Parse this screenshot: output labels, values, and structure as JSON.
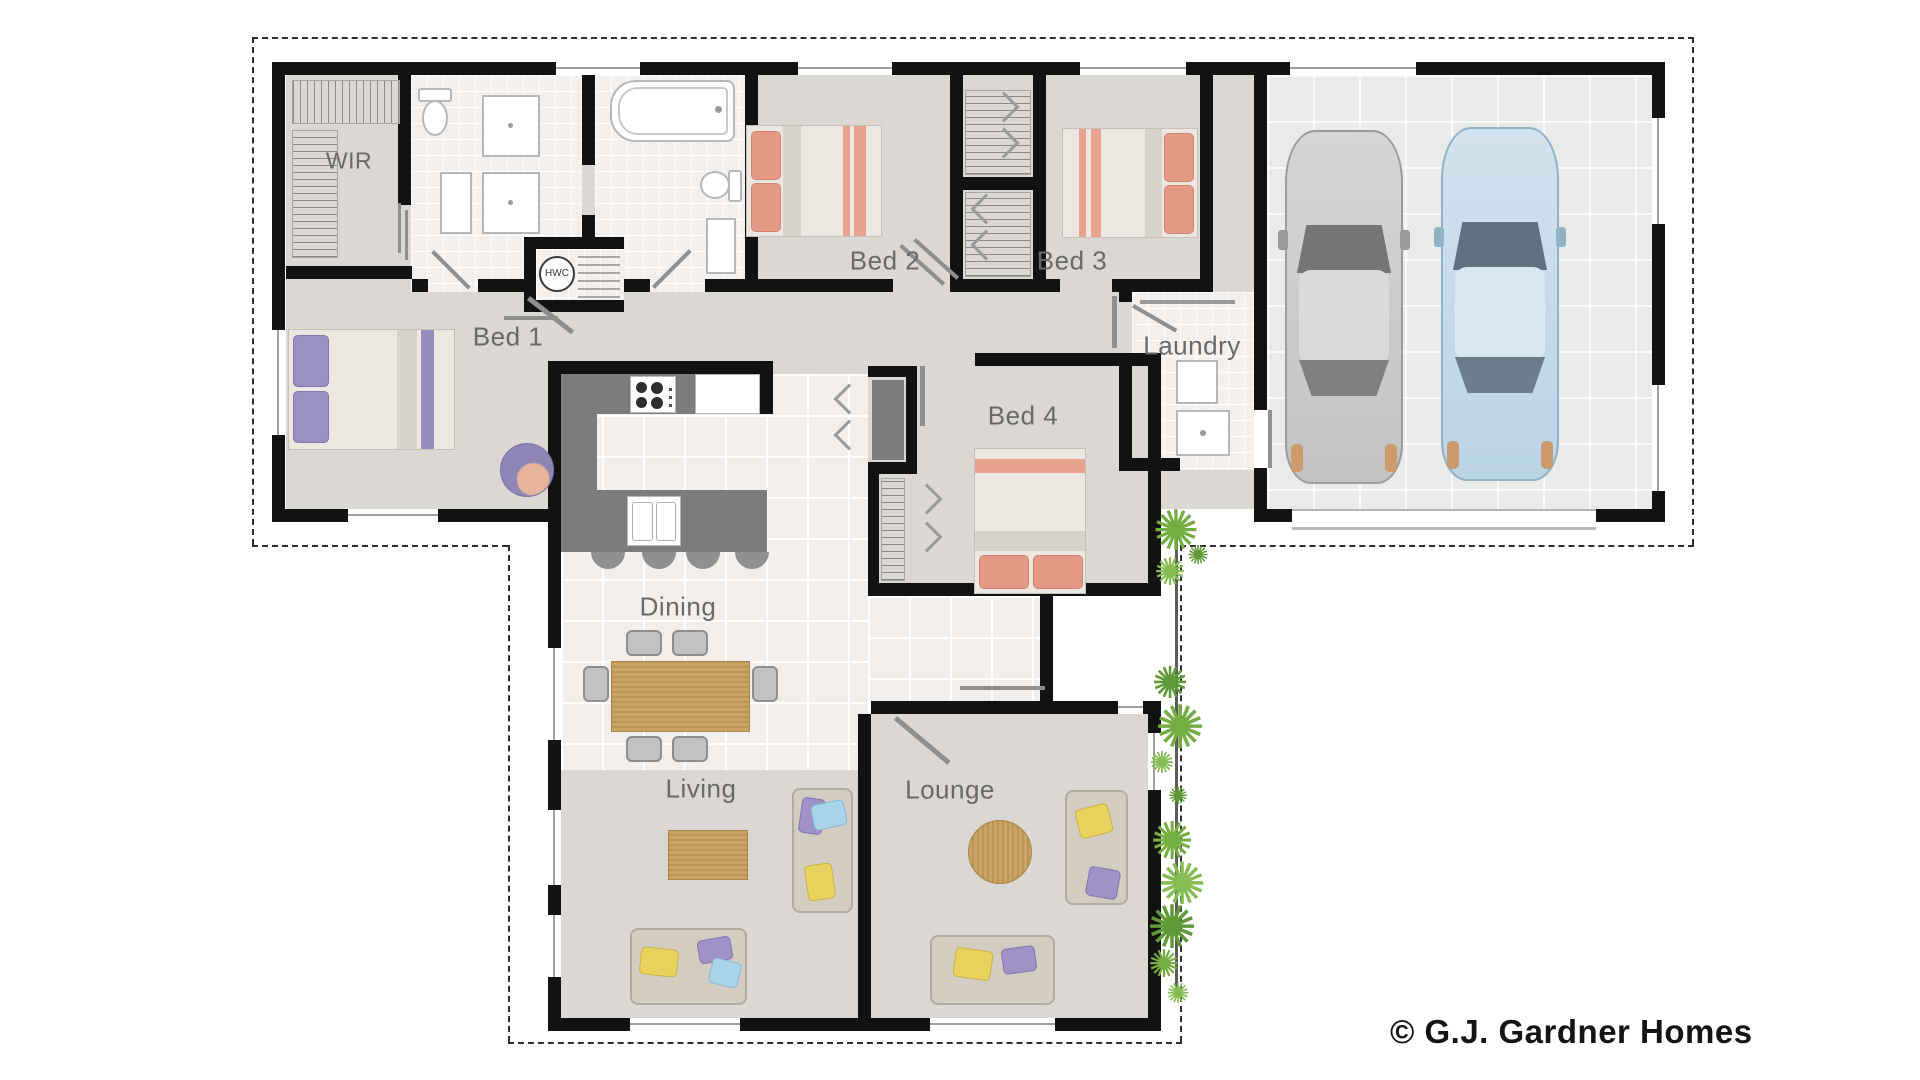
{
  "copyright": "© G.J. Gardner Homes",
  "rooms": {
    "wir": "WIR",
    "bed1": "Bed 1",
    "bed2": "Bed 2",
    "bed3": "Bed 3",
    "bed4": "Bed 4",
    "laundry": "Laundry",
    "dining": "Dining",
    "living": "Living",
    "lounge": "Lounge"
  },
  "fixtures": {
    "hwc": "HWC"
  },
  "colors": {
    "wall": "#121212",
    "floor_warm_gray": "#dbd7d3",
    "floor_tile": "#f2efec",
    "garage_floor": "#eaeae9",
    "counter_dark_gray": "#7c7c7c",
    "wood": "#c9a465",
    "label_gray": "#696969",
    "bed_accent_salmon": "#e59a86",
    "bed_accent_purple": "#9a90c2",
    "cushion_yellow": "#e9d15e",
    "cushion_purple": "#9e92c6",
    "cushion_blue": "#a9d3ea",
    "car_gray": "#cbcbcb",
    "car_blue": "#bdd8e8",
    "plant_green": "#74ad41",
    "door_gray": "#8f8f8f",
    "boundary_dash": "#2e2e2e"
  },
  "icons": {
    "beds": "double-bed-icon",
    "cars": "car-icon",
    "plants": "tree-icon",
    "sofas": "sofa-icon",
    "tables": "table-icon",
    "bath": "bathtub-icon",
    "showers": "shower-icon",
    "toilets": "toilet-icon",
    "vanities": "vanity-icon",
    "cooktop": "cooktop-icon",
    "sink": "sink-icon",
    "hot_water": "hwc-icon"
  }
}
